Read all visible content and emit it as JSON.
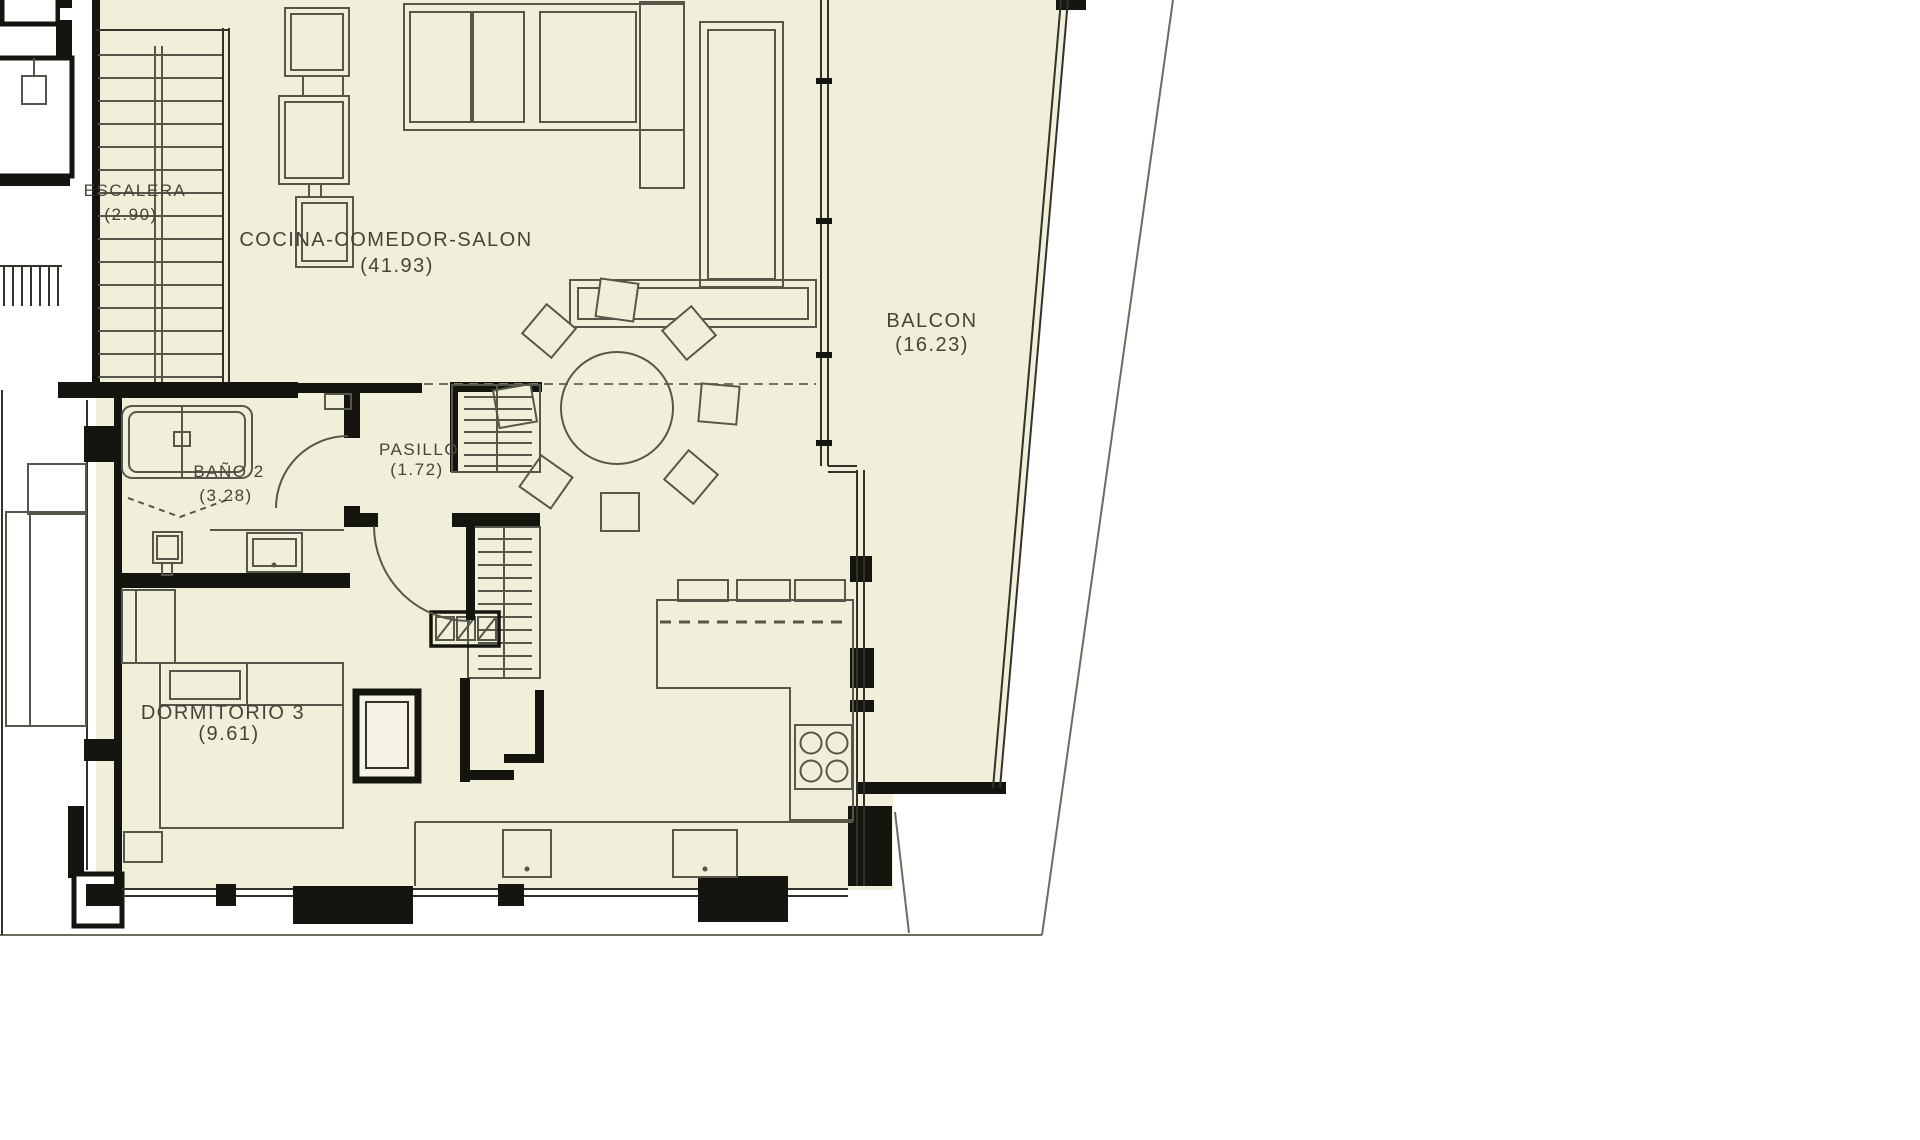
{
  "plan": {
    "type": "architectural-floor-plan",
    "language": "es",
    "rooms": {
      "escalera": {
        "name": "ESCALERA",
        "area": "(2.90)"
      },
      "cocina": {
        "name": "COCINA-COMEDOR-SALON",
        "area": "(41.93)"
      },
      "balcon": {
        "name": "BALCON",
        "area": "(16.23)"
      },
      "pasillo": {
        "name": "PASILLO",
        "area": "(1.72)"
      },
      "bano2": {
        "name": "BAÑO 2",
        "area": "(3.28)"
      },
      "dormitorio3": {
        "name": "DORMITORIO 3",
        "area": "(9.61)"
      }
    },
    "colors": {
      "floor": "#f1efda",
      "wall": "#15150f",
      "furniture_line": "#57564a",
      "plot_line": "#6d6c5e",
      "label_text": "#45443a",
      "background": "#ffffff"
    }
  }
}
